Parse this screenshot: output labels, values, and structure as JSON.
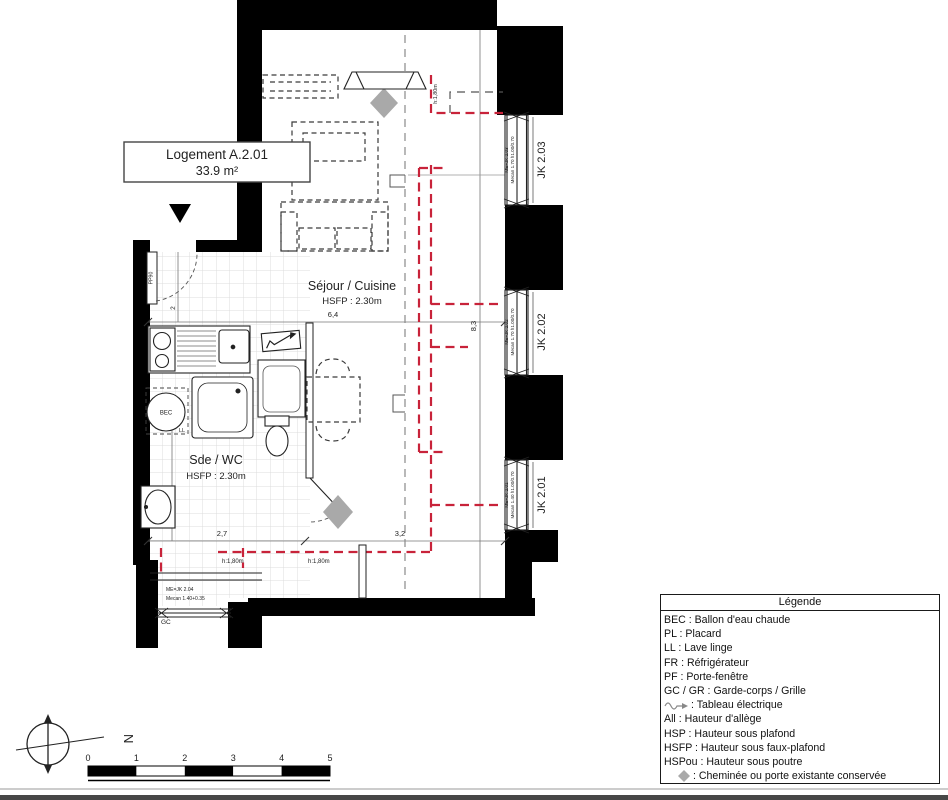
{
  "colors": {
    "red": "#C8233A",
    "diamond": "#A9A9A9",
    "wall": "#000000",
    "tile": "#DCDCDC"
  },
  "unit": {
    "name": "Logement A.2.01",
    "area": "33.9 m²"
  },
  "rooms": {
    "sejour": {
      "name": "Séjour / Cuisine",
      "height": "HSFP : 2.30m"
    },
    "sde": {
      "name": "Sde / WC",
      "height": "HSFP : 2.30m"
    }
  },
  "windows": [
    {
      "id": "JK 2.03",
      "note1": "ME=JK 2.03",
      "note2": "Mecan 1.70 h1.00/0.70"
    },
    {
      "id": "JK 2.02",
      "note1": "ME=JK 2.02",
      "note2": "Mecan 1.70 h1.00/0.70"
    },
    {
      "id": "JK 2.01",
      "note1": "ME=JK 2.01",
      "note2": "Mecan 1.40 h1.00/0.70"
    }
  ],
  "doors": {
    "entry_label": "PP90",
    "balcony": {
      "note1": "ME=JK 2.04",
      "note2": "Mecan 1.40+0.35",
      "gc": "GC"
    }
  },
  "equipment": {
    "bec": "BEC",
    "ll": "LL"
  },
  "heights": {
    "v1": "h:1,80m",
    "b1": "h:1,80m",
    "b2": "h:1,80m"
  },
  "dims": {
    "w": "6,4",
    "h": "8,3",
    "d1": "2,7",
    "d2": "3,2",
    "d3": "3,8",
    "d4": "2"
  },
  "legend": {
    "title": "Légende",
    "items": [
      {
        "text": "BEC : Ballon d'eau chaude"
      },
      {
        "text": "PL : Placard"
      },
      {
        "text": "LL : Lave linge"
      },
      {
        "text": "FR : Réfrigérateur"
      },
      {
        "text": "PF : Porte-fenêtre"
      },
      {
        "text": "GC / GR : Garde-corps / Grille"
      },
      {
        "icon": "tableau-electrique-arrow-icon",
        "text": ": Tableau électrique"
      },
      {
        "text": "All : Hauteur d'allège"
      },
      {
        "text": "HSP : Hauteur sous plafond"
      },
      {
        "text": "HSFP : Hauteur sous faux-plafond"
      },
      {
        "text": "HSPou : Hauteur sous poutre"
      },
      {
        "icon": "cheminee-diamond-icon",
        "text": ": Cheminée ou porte existante conservée"
      }
    ]
  },
  "scalebar": {
    "ticks": [
      "0",
      "1",
      "2",
      "3",
      "4",
      "5"
    ]
  },
  "compass": {
    "north": "N"
  }
}
